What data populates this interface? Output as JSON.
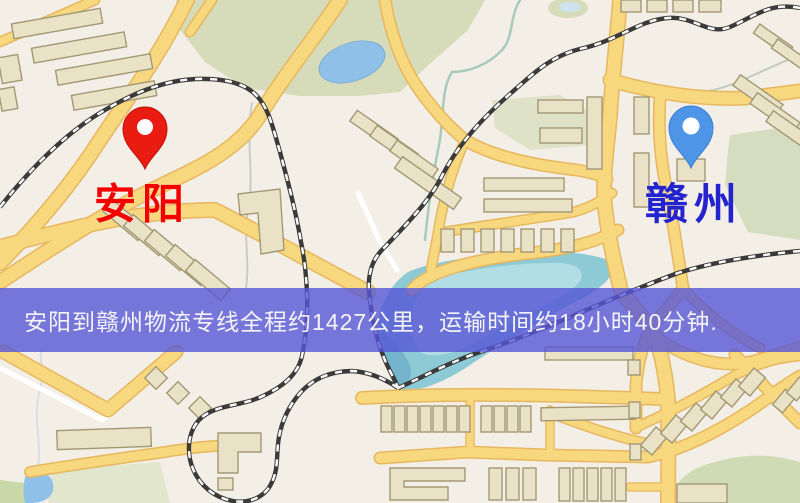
{
  "map": {
    "origin": {
      "label": "安阳",
      "label_color": "#f40000",
      "pin_color": "#ea1b10",
      "pin_stroke": "#c01008"
    },
    "destination": {
      "label": "赣州",
      "label_color": "#2424cf",
      "pin_color": "#4e95e7",
      "pin_stroke": "#3c7fd0"
    },
    "banner": {
      "text": "安阳到赣州物流专线全程约1427公里，运输时间约18小时40分钟.",
      "bg_color": "#5656d6",
      "text_color": "#f5f5f5"
    },
    "colors": {
      "background": "#f4efe6",
      "road_fill": "#f8d87f",
      "road_casing": "#e6b75f",
      "building": "#eae2c6",
      "park_green": "#d6dcba",
      "water_teal": "#8ec9d6",
      "lake_blue": "#8fc0e8",
      "railway": "#3a3a3a"
    }
  }
}
